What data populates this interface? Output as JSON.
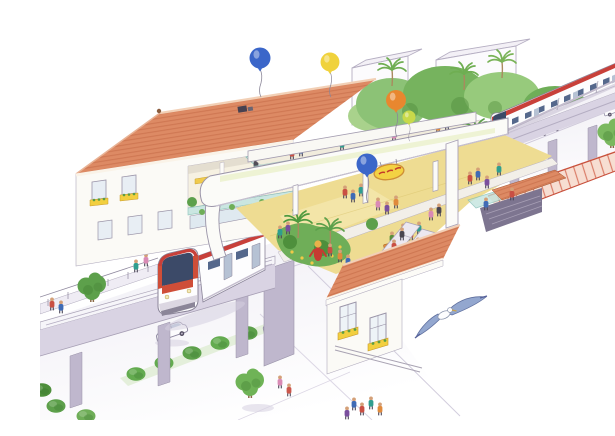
{
  "meta": {
    "artwork_type": "watercolor architectural concept illustration",
    "subject": "Elevated light-rail transit station with rooftop terrace building, landscaped platform, street level below, trains, balloons and a seagull",
    "canvas": {
      "width": 615,
      "height": 404
    }
  },
  "scene": {
    "sky": {
      "balloons": [
        {
          "name": "blue-balloon",
          "x": 220,
          "y": 42,
          "color": "#3b66c9"
        },
        {
          "name": "yellow-balloon",
          "x": 290,
          "y": 46,
          "color": "#f0d23c"
        },
        {
          "name": "orange-balloon",
          "x": 356,
          "y": 84,
          "color": "#e8872f"
        },
        {
          "name": "lime-balloon",
          "x": 369,
          "y": 101,
          "color": "#c8d94a"
        },
        {
          "name": "platform-blue-balloon",
          "x": 327,
          "y": 148,
          "color": "#3b66c9"
        }
      ],
      "bird": {
        "type": "seagull",
        "x": 408,
        "y": 297
      }
    },
    "background": {
      "buildings": [
        "white block building left",
        "white block building right",
        "white tower far right"
      ],
      "vegetation": "dense broadleaf tree masses with palm trees"
    },
    "rail": {
      "upper_line": {
        "guideway": "elevated concrete viaduct on columns",
        "train": {
          "body": "white",
          "stripe": "red roofline stripe",
          "state": "running toward upper right"
        }
      },
      "lower_line": {
        "guideway": "elevated guideway with pedestrian side-walkway",
        "train": {
          "body": "white",
          "front": "red-orange mask around dark windshield",
          "state": "emerging from station portal toward lower left"
        }
      }
    },
    "station": {
      "main_building": {
        "roof": "terracotta hip tile roof",
        "features": [
          "rooftop terrace cafe with tables and yellow bench",
          "windows with yellow flower boxes",
          "escalator to platform"
        ]
      },
      "platform": {
        "floor": "pale yellow paving",
        "canopy": "long white arched canopy with skylight strip",
        "landscaping": "tropical palm garden bed with yellow flowers",
        "sign": {
          "shape": "oval",
          "background": "yellow",
          "text_appearance": "illegible red lettering"
        },
        "crowd_approx": 30,
        "mascot": "red costumed greeter figure"
      },
      "entrance_pavilion": {
        "roof": "terracotta tile roof",
        "windows": "white frames with yellow flower boxes",
        "escalators": "twin escalators down to street level"
      },
      "street_plaza": {
        "paving": "pink plaza with red stripe pattern"
      },
      "sunken_entrance": "stairwell with teal glass balustrade and small tile canopy"
    },
    "street": {
      "left": {
        "cars": 2,
        "median_bushes": 6,
        "trees": 2,
        "pedestrians": "adult with child plus crossing group"
      },
      "right": {
        "cars": 2,
        "hedge_bushes": 5,
        "trees": 1,
        "seated_figures": 2
      }
    }
  },
  "palette": {
    "paper": "#ffffff",
    "roof_tile": "#dd8a64",
    "roof_line": "#bc5f3c",
    "foliage_dark": "#4e9a3f",
    "foliage_mid": "#7ab85f",
    "foliage_light": "#a9d28c",
    "platform_floor": "#eedc92",
    "canopy_white": "#fbfbf8",
    "structure": "#d9d3e3",
    "structure_shade": "#bfb7cd",
    "road": "#f1eff5",
    "train_body": "#fdfdfe",
    "train_stripe": "#c8403a",
    "train_window": "#55688c",
    "train_front": "#cf4e38",
    "glass_teal": "#bfe2dc",
    "plaza_pink": "#f7ded2",
    "plaza_stripe": "#d2664e",
    "sign_yellow": "#f3d243",
    "sign_text": "#c43b2a",
    "bird_wing": "#93a7cf",
    "skin": "#d4a078",
    "people_colors": [
      "#c94f43",
      "#3f6bb5",
      "#2f9e8f",
      "#d98ab5",
      "#7a4f9e",
      "#e08a3c",
      "#5a8f3c",
      "#4a4550"
    ]
  }
}
